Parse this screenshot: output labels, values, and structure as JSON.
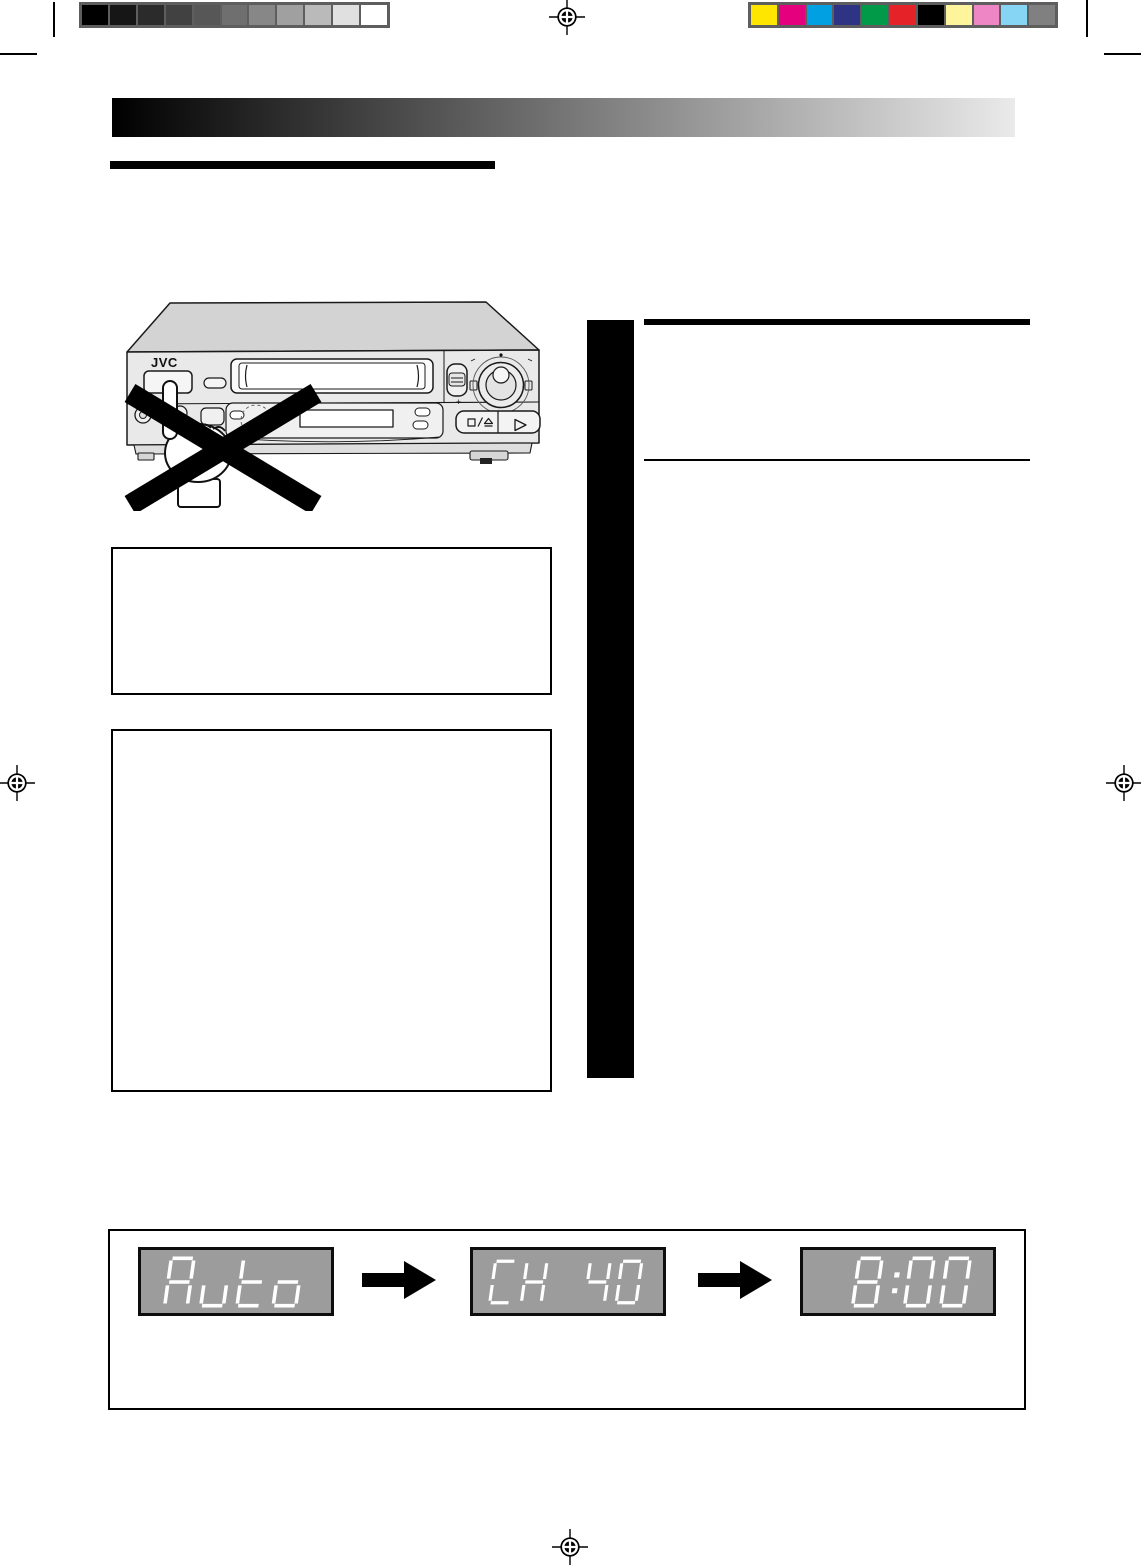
{
  "document": {
    "type": "vcr-instruction-manual-page",
    "background": "#ffffff"
  },
  "calibration": {
    "strip_bg": "#5e5e5e",
    "grayscale": [
      "#000000",
      "#161616",
      "#2b2b2b",
      "#414141",
      "#575757",
      "#6f6f6f",
      "#878787",
      "#a0a0a0",
      "#bababa",
      "#e0e0e0",
      "#ffffff"
    ],
    "colors": [
      "#ffe600",
      "#e5007e",
      "#00a0e3",
      "#2f3383",
      "#009a49",
      "#e62229",
      "#000000",
      "#fdf49c",
      "#ee86c6",
      "#86d5f5",
      "#808080"
    ]
  },
  "header": {
    "gradient_from": "#000000",
    "gradient_to": "#eaeaea",
    "title_bar_color": "#000000"
  },
  "vcr": {
    "logo": "JVC",
    "plus_label": "+",
    "icons": [
      "power-button",
      "cassette-slot",
      "jog-shuttle-dial",
      "channel-rocker",
      "stop-eject-button",
      "play-button",
      "display-window",
      "pointing-hand",
      "prohibition-x"
    ]
  },
  "lcd_sequence": {
    "panel_bg": "#9c9c9c",
    "segment_color": "#ffffff",
    "displays": [
      {
        "text": "Auto",
        "align": "center"
      },
      {
        "text": "CH 40",
        "align": "center"
      },
      {
        "text": "8:00",
        "align": "right"
      }
    ]
  }
}
